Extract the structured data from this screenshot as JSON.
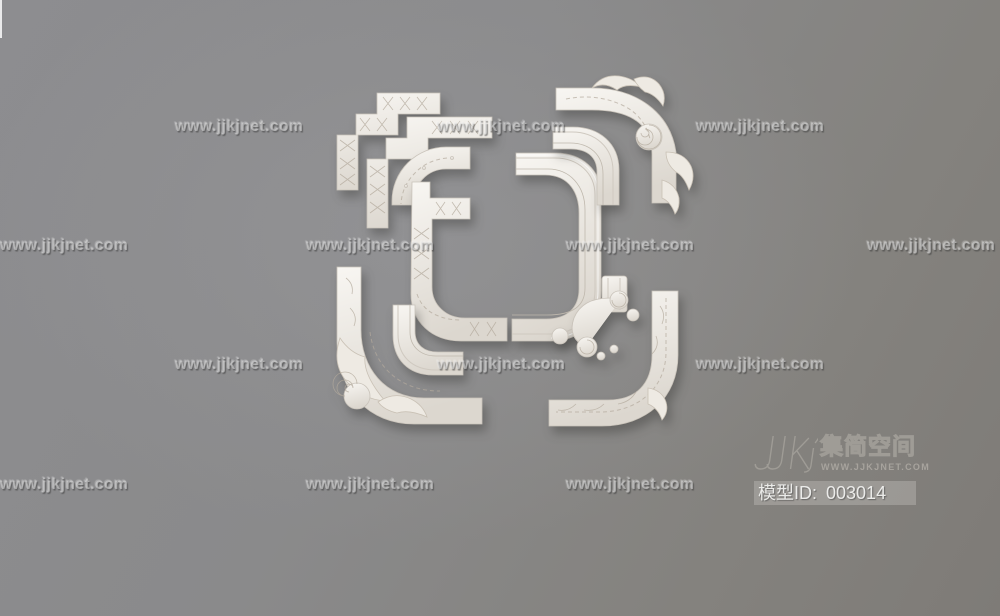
{
  "image": {
    "subject": "Set of white ornate plaster corner moldings, 3D render"
  },
  "colors": {
    "background": "#8a8a8c",
    "background_warm": "#7e7b77",
    "molding": "#f3f0ec",
    "watermark": "#e2e2e2",
    "logo_outline": "#9f9c96"
  },
  "watermark": {
    "text": "www.jjkjnet.com",
    "rows": [
      {
        "y": 119,
        "xs": [
          175,
          437,
          696
        ]
      },
      {
        "y": 238,
        "xs": [
          0,
          306,
          566,
          867
        ]
      },
      {
        "y": 357,
        "xs": [
          175,
          437,
          696
        ]
      },
      {
        "y": 477,
        "xs": [
          0,
          306,
          566
        ]
      }
    ]
  },
  "logo": {
    "brand": "集简空间",
    "site": "WWW.JJKJNET.COM",
    "model_label": "模型ID:",
    "model_value": "003014"
  }
}
